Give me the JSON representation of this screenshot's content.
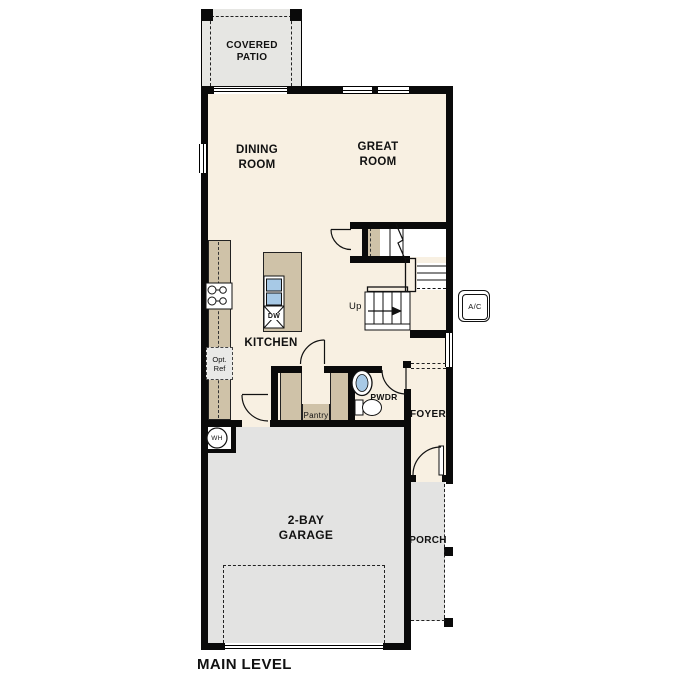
{
  "title": {
    "level_label": "MAIN LEVEL"
  },
  "rooms": {
    "covered_patio": {
      "line1": "COVERED",
      "line2": "PATIO"
    },
    "dining_room": {
      "line1": "DINING",
      "line2": "ROOM"
    },
    "great_room": {
      "line1": "GREAT",
      "line2": "ROOM"
    },
    "kitchen": {
      "label": "KITCHEN"
    },
    "pantry": {
      "label": "Pantry"
    },
    "powder_room": {
      "label": "PWDR"
    },
    "foyer": {
      "label": "FOYER"
    },
    "garage": {
      "line1": "2-BAY",
      "line2": "GARAGE"
    },
    "porch": {
      "label": "PORCH"
    }
  },
  "fixtures": {
    "stairs_up": "Up",
    "ac_unit": "A/C",
    "water_heater": "WH",
    "dishwasher": "DW",
    "optional_refrigerator": {
      "line1": "Opt.",
      "line2": "Ref"
    }
  },
  "colors": {
    "floor": "#f8f0e2",
    "patio": "#e6e6e3",
    "garage": "#e3e3e2",
    "porch": "#e3e3e2",
    "casework": "#cfc2a8",
    "fixture_blue": "#a7c9e6",
    "wall": "#0a0a0a"
  }
}
